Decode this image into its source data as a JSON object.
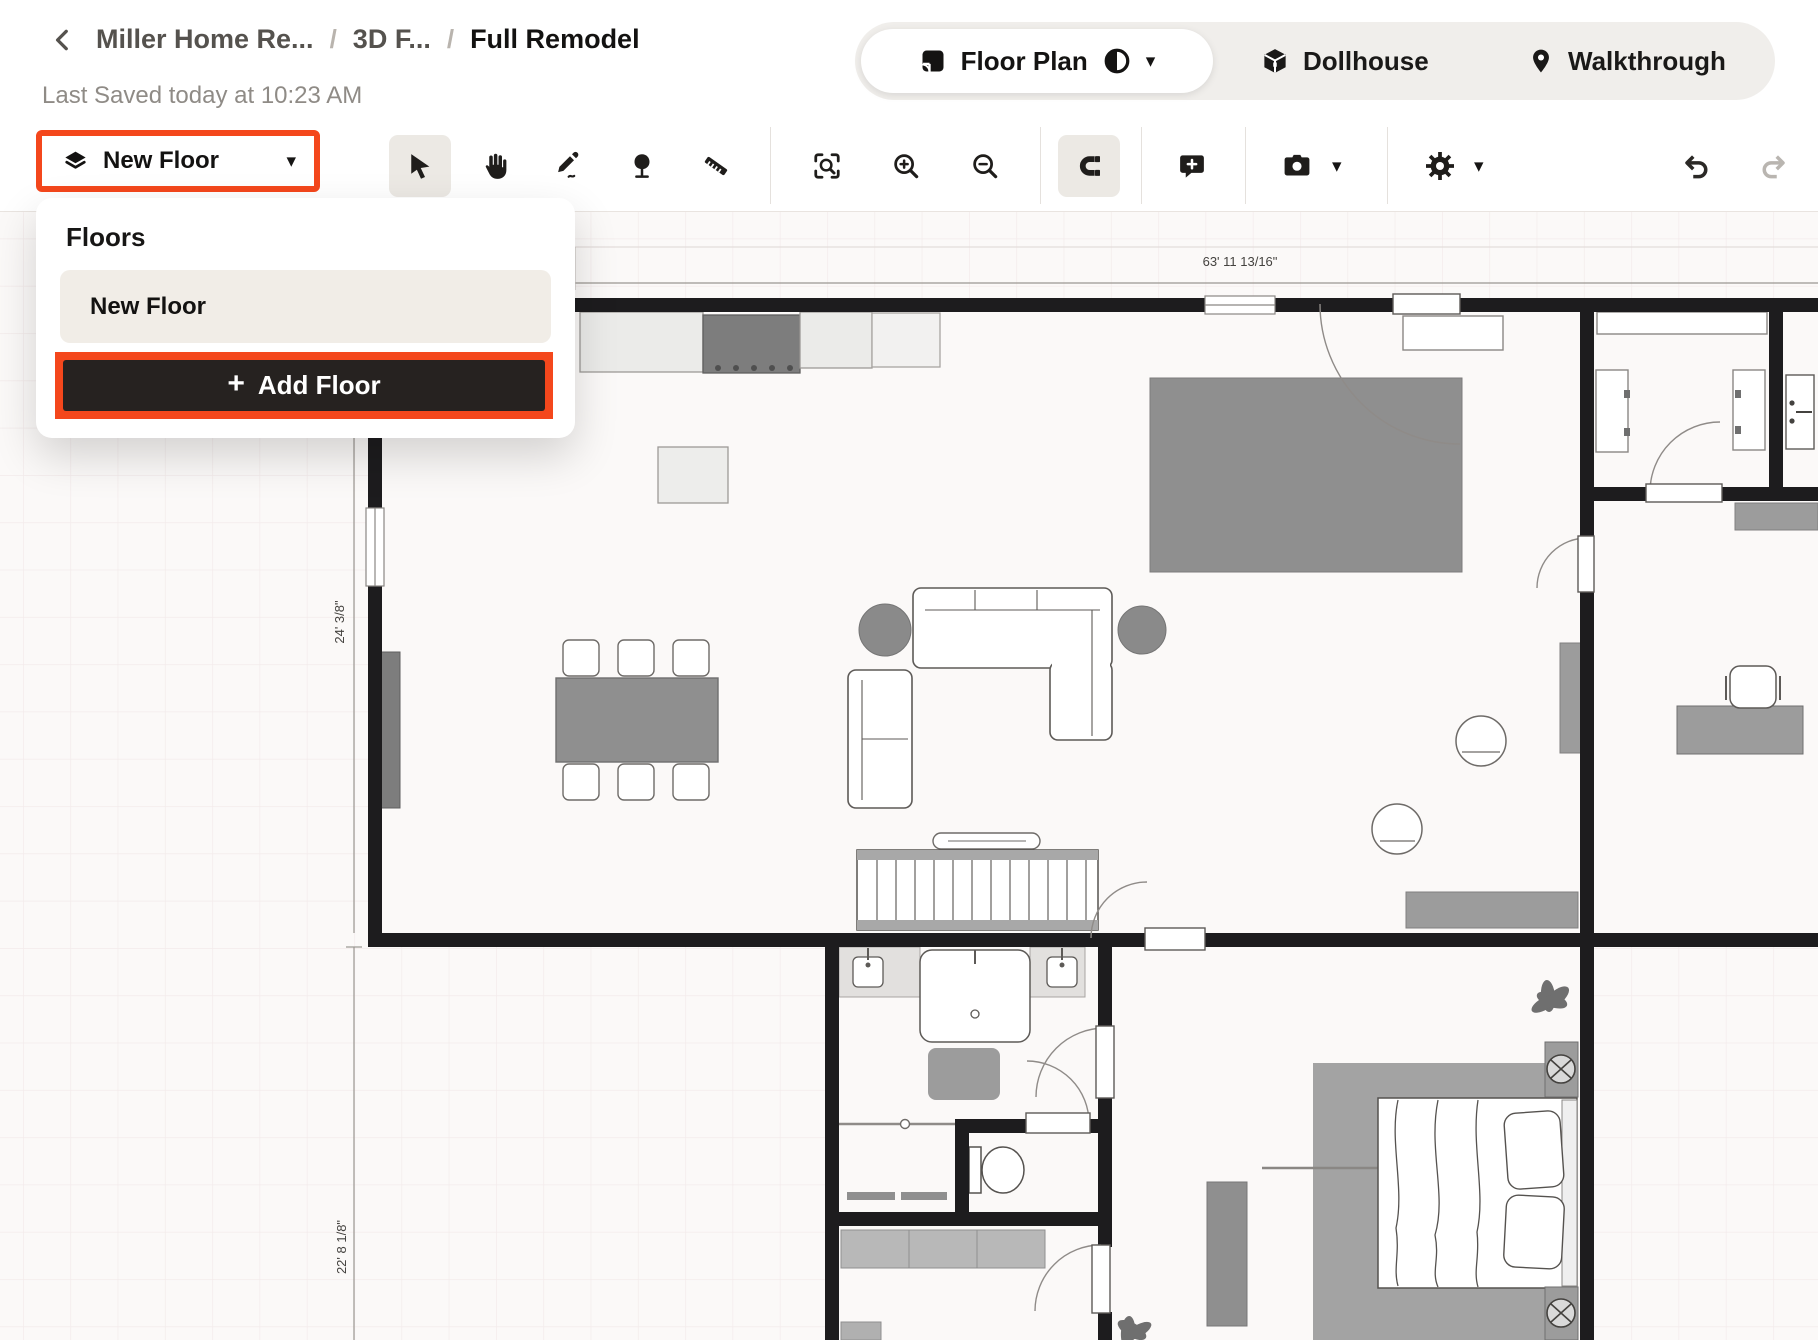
{
  "header": {
    "breadcrumb": {
      "back_icon": "chevron-left-icon",
      "items": [
        "Miller Home Re...",
        "3D F...",
        "Full Remodel"
      ],
      "separator": "/",
      "last_saved": "Last Saved today at 10:23 AM"
    },
    "view_switcher": {
      "floor_plan": "Floor Plan",
      "dollhouse": "Dollhouse",
      "walkthrough": "Walkthrough",
      "caret": "▾"
    }
  },
  "toolbar": {
    "floor_selector": {
      "label": "New Floor",
      "icon": "layers-icon",
      "caret": "▾"
    },
    "tools": [
      {
        "name": "select",
        "icon": "cursor-icon",
        "active": true
      },
      {
        "name": "pan",
        "icon": "hand-icon",
        "active": false
      },
      {
        "name": "draw",
        "icon": "pencil-icon",
        "active": false
      },
      {
        "name": "plants",
        "icon": "tree-icon",
        "active": false
      },
      {
        "name": "measure",
        "icon": "ruler-icon",
        "active": false
      },
      {
        "name": "zoom-to-fit",
        "icon": "zoom-fit-icon",
        "active": false
      },
      {
        "name": "zoom-in",
        "icon": "zoom-in-icon",
        "active": false
      },
      {
        "name": "zoom-out",
        "icon": "zoom-out-icon",
        "active": false
      },
      {
        "name": "snap",
        "icon": "magnet-icon",
        "active": true
      },
      {
        "name": "comment",
        "icon": "comment-plus-icon",
        "active": false
      },
      {
        "name": "snapshot",
        "icon": "camera-icon",
        "active": false,
        "has_caret": true
      },
      {
        "name": "settings",
        "icon": "gear-icon",
        "active": false,
        "has_caret": true
      },
      {
        "name": "undo",
        "icon": "undo-icon",
        "enabled": true
      },
      {
        "name": "redo",
        "icon": "redo-icon",
        "enabled": false
      }
    ]
  },
  "floors_panel": {
    "title": "Floors",
    "items": [
      {
        "name": "New Floor",
        "selected": true
      }
    ],
    "add_floor_icon": "+",
    "add_floor_label": "Add Floor"
  },
  "canvas": {
    "dimension_labels": {
      "top_width": "63' 11 13/16\"",
      "left_upper_height": "24' 3/8\"",
      "left_lower_height": "22' 8 1/8\""
    }
  },
  "colors": {
    "highlight_orange": "#F4471C",
    "dark_button": "#262220",
    "wall": "#1D1C1E",
    "active_tool_bg": "#ECE9E4",
    "furniture_gray": "#8F8F8F",
    "canvas_bg": "#FBF9F8"
  }
}
